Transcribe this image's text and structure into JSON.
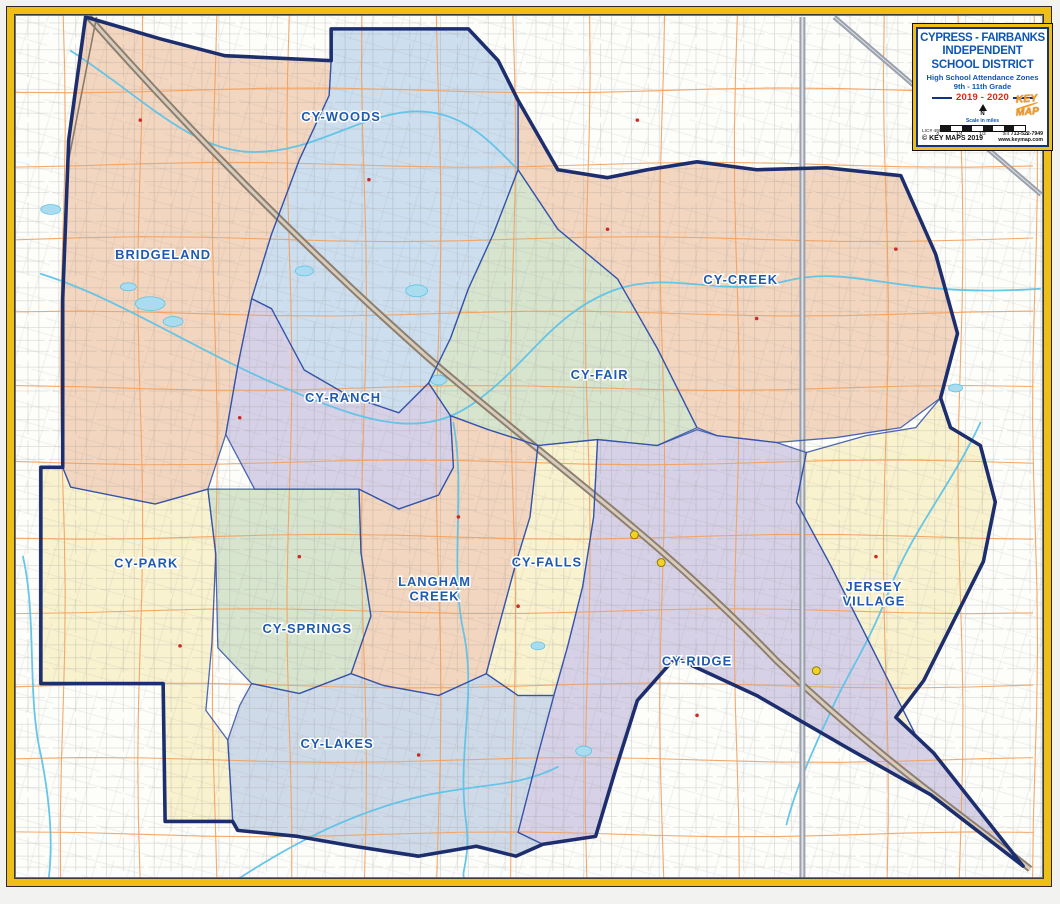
{
  "title_box": {
    "line1": "CYPRESS - FAIRBANKS",
    "line2": "INDEPENDENT",
    "line3": "SCHOOL DISTRICT",
    "line4": "High School Attendance Zones",
    "line5": "9th - 11th Grade",
    "year": "2019 - 2020",
    "north_label": "N",
    "scale_label": "Scale in miles",
    "scale_ticks": [
      "0",
      "1/4",
      "1/2",
      "3/4",
      "1"
    ],
    "license": "LIC# 490",
    "copyright": "© KEY MAPS 2019",
    "phone": "713-522-7949",
    "website": "www.keymap.com",
    "logo_line1": "KEY",
    "logo_line2": "MAP"
  },
  "colors": {
    "frame_gold": "#eebf17",
    "district_boundary": "#1d2e6e",
    "zone_divider": "#3050a8",
    "zone_label_blue": "#1e5ab0",
    "creek_blue": "#5ec3e8",
    "lake_fill": "#aadcf0",
    "arterial_orange": "#f2a05c",
    "street_gray": "#8f8f8f",
    "freeway_tan": "#8d7f6f",
    "marker_yellow": "#f4d225",
    "school_red": "#cc2a22",
    "peach": "#f3d6bf",
    "light_blue": "#cddeee",
    "light_green": "#d7e4ce",
    "lavender": "#d6d1e6",
    "cream": "#f9f2cf",
    "blue_gray": "#cfdae8"
  },
  "map": {
    "district_boundary_path": "M 85,16 L 160,38 L 225,55 L 332,60 L 332,28 L 470,28 L 500,60 L 520,100 L 560,170 L 610,178 L 650,170 L 700,162 L 760,170 L 830,168 L 905,176 L 940,255 L 962,335 L 945,400 L 955,430 L 985,448 L 1000,505 L 988,565 L 958,625 L 928,685 L 900,722 L 938,758 L 1028,872 L 935,800 L 855,755 L 760,700 L 678,662 L 640,705 L 618,775 L 598,842 L 545,850 L 518,862 L 478,852 L 420,862 L 355,852 L 298,842 L 238,836 L 233,827 L 165,827 L 163,688 L 40,688 L 40,470 L 62,470 L 62,300 L 68,140 Z",
    "zones": [
      {
        "id": "bridgeland",
        "label_lines": [
          "BRIDGELAND"
        ],
        "color_key": "peach",
        "label_x": 163,
        "label_y": 260,
        "points": "85,16 160,38 225,55 332,60 330,95 300,160 272,235 252,300 238,368 226,437 208,492 155,507 70,490 62,470 62,300 68,140"
      },
      {
        "id": "cy-woods",
        "label_lines": [
          "CY-WOODS"
        ],
        "color_key": "light_blue",
        "label_x": 342,
        "label_y": 121,
        "points": "332,60 332,28 470,28 500,60 520,100 520,170 495,235 470,290 452,340 430,385 400,415 350,398 305,372 272,310 252,300 272,235 300,160 330,95"
      },
      {
        "id": "cy-creek",
        "label_lines": [
          "CY-CREEK"
        ],
        "color_key": "peach",
        "label_x": 744,
        "label_y": 285,
        "points": "520,100 560,170 610,178 650,170 700,162 760,170 830,168 905,176 940,255 962,335 945,400 905,430 840,440 780,445 720,438 700,430 660,350 620,280 560,230 520,170"
      },
      {
        "id": "cy-fair",
        "label_lines": [
          "CY-FAIR"
        ],
        "color_key": "light_green",
        "label_x": 602,
        "label_y": 381,
        "points": "520,170 560,230 620,280 660,350 700,430 660,448 600,442 540,448 490,432 452,418 430,385 452,340 470,290 495,235"
      },
      {
        "id": "cy-ranch",
        "label_lines": [
          "CY-RANCH"
        ],
        "color_key": "lavender",
        "label_x": 344,
        "label_y": 404,
        "points": "252,300 272,310 305,372 350,398 400,415 430,385 452,418 455,470 440,498 400,512 360,492 310,492 255,492 226,437 238,368"
      },
      {
        "id": "cy-park",
        "label_lines": [
          "CY-PARK"
        ],
        "color_key": "cream",
        "label_x": 146,
        "label_y": 571,
        "points": "40,470 62,470 70,490 155,507 208,492 216,558 212,648 206,715 228,745 233,827 165,827 163,688 40,688"
      },
      {
        "id": "cy-springs",
        "label_lines": [
          "CY-SPRINGS"
        ],
        "color_key": "light_green",
        "label_x": 308,
        "label_y": 637,
        "points": "216,558 208,492 255,492 310,492 360,492 362,556 372,620 352,678 300,698 252,688 218,652"
      },
      {
        "id": "langham-creek",
        "label_lines": [
          "LANGHAM",
          "CREEK"
        ],
        "color_key": "peach",
        "label_x": 436,
        "label_y": 597,
        "points": "360,492 400,512 440,498 455,470 452,418 490,432 540,448 532,520 518,566 498,640 488,678 440,700 385,690 352,678 372,620 362,556"
      },
      {
        "id": "cy-falls",
        "label_lines": [
          "CY-FALLS"
        ],
        "color_key": "cream",
        "label_x": 549,
        "label_y": 570,
        "points": "540,448 600,442 596,520 585,590 570,650 556,700 520,700 488,678 498,640 518,566 532,520"
      },
      {
        "id": "cy-ridge",
        "label_lines": [
          "CY-RIDGE"
        ],
        "color_key": "lavender",
        "label_x": 700,
        "label_y": 670,
        "points": "600,442 660,448 700,432 720,438 780,445 810,455 800,505 835,570 870,640 900,700 920,740 938,758 1028,872 935,800 855,755 760,700 678,662 640,705 618,775 598,842 545,850 520,838 540,760 556,700 570,650 585,590 596,520"
      },
      {
        "id": "jersey-village",
        "label_lines": [
          "JERSEY",
          "VILLAGE"
        ],
        "color_key": "cream",
        "label_x": 878,
        "label_y": 602,
        "points": "810,455 870,438 920,430 945,400 955,430 985,448 1000,505 988,565 958,625 928,685 900,722 938,758 920,740 900,700 870,640 835,570 800,505"
      },
      {
        "id": "cy-lakes",
        "label_lines": [
          "CY-LAKES"
        ],
        "color_key": "blue_gray",
        "label_x": 338,
        "label_y": 753,
        "points": "252,688 300,698 352,678 385,690 440,700 488,678 520,700 556,700 540,760 520,838 545,850 518,862 478,852 420,862 355,852 298,842 238,836 233,827 228,745 240,710"
      }
    ],
    "freeways": [
      {
        "name": "us-290-freeway",
        "path": "M 88,16 C 180,120 300,245 430,360 C 560,472 660,540 780,665 C 890,770 980,830 1035,875",
        "casing": "#8d7f6f",
        "center": "#d8cdbc",
        "w": 7
      },
      {
        "name": "beltway-8-freeway",
        "path": "M 806,16 L 806,884",
        "casing": "#9aa0ac",
        "center": "#dfe3e9",
        "w": 6
      },
      {
        "name": "sh-249-freeway",
        "path": "M 838,16 L 1046,195",
        "casing": "#9aa0ac",
        "center": "#dfe3e9",
        "w": 5
      },
      {
        "name": "railroad-line",
        "path": "M 96,16 L 68,160 L 62,290",
        "casing": "#8a7a6a",
        "center": "#8a7a6a",
        "w": 1.6
      }
    ],
    "creeks": [
      "M 40,275 C 120,300 200,355 290,392 C 380,430 430,440 480,402 C 530,365 555,315 615,292 C 675,270 720,300 790,282 C 860,265 900,300 1045,290",
      "M 70,50 C 140,95 190,150 250,152 C 310,154 350,120 405,112 C 460,105 490,140 518,168",
      "M 455,425 C 468,500 450,570 466,640 C 478,705 458,760 468,830 C 472,865 462,880 466,884",
      "M 240,884 C 300,845 360,815 430,800 C 490,788 520,792 560,772",
      "M 985,425 C 955,490 915,535 893,595 C 872,650 850,680 835,715 C 820,748 800,790 790,830",
      "M 920,60 C 950,100 990,130 1045,142",
      "M 22,560 C 36,620 26,700 40,760 C 50,810 52,850 48,884"
    ],
    "lakes": [
      [
        150,
        305,
        15,
        7
      ],
      [
        173,
        323,
        10,
        5
      ],
      [
        128,
        288,
        8,
        4
      ],
      [
        305,
        272,
        9,
        5
      ],
      [
        418,
        292,
        11,
        6
      ],
      [
        440,
        382,
        8,
        5
      ],
      [
        540,
        650,
        7,
        4
      ],
      [
        586,
        756,
        8,
        5
      ],
      [
        50,
        210,
        10,
        5
      ],
      [
        960,
        390,
        7,
        4
      ]
    ],
    "grid": {
      "vx": [
        62,
        140,
        215,
        290,
        365,
        440,
        515,
        590,
        665,
        740,
        890,
        965,
        1040
      ],
      "hy": [
        90,
        165,
        240,
        315,
        390,
        465,
        540,
        615,
        690,
        765,
        840
      ]
    },
    "interchange_markers": [
      [
        637,
        538
      ],
      [
        664,
        566
      ],
      [
        820,
        675
      ]
    ],
    "school_markers": [
      [
        140,
        120
      ],
      [
        370,
        180
      ],
      [
        610,
        230
      ],
      [
        760,
        320
      ],
      [
        460,
        520
      ],
      [
        300,
        560
      ],
      [
        520,
        610
      ],
      [
        700,
        720
      ],
      [
        420,
        760
      ],
      [
        880,
        560
      ],
      [
        240,
        420
      ],
      [
        180,
        650
      ],
      [
        640,
        120
      ],
      [
        900,
        250
      ]
    ]
  }
}
